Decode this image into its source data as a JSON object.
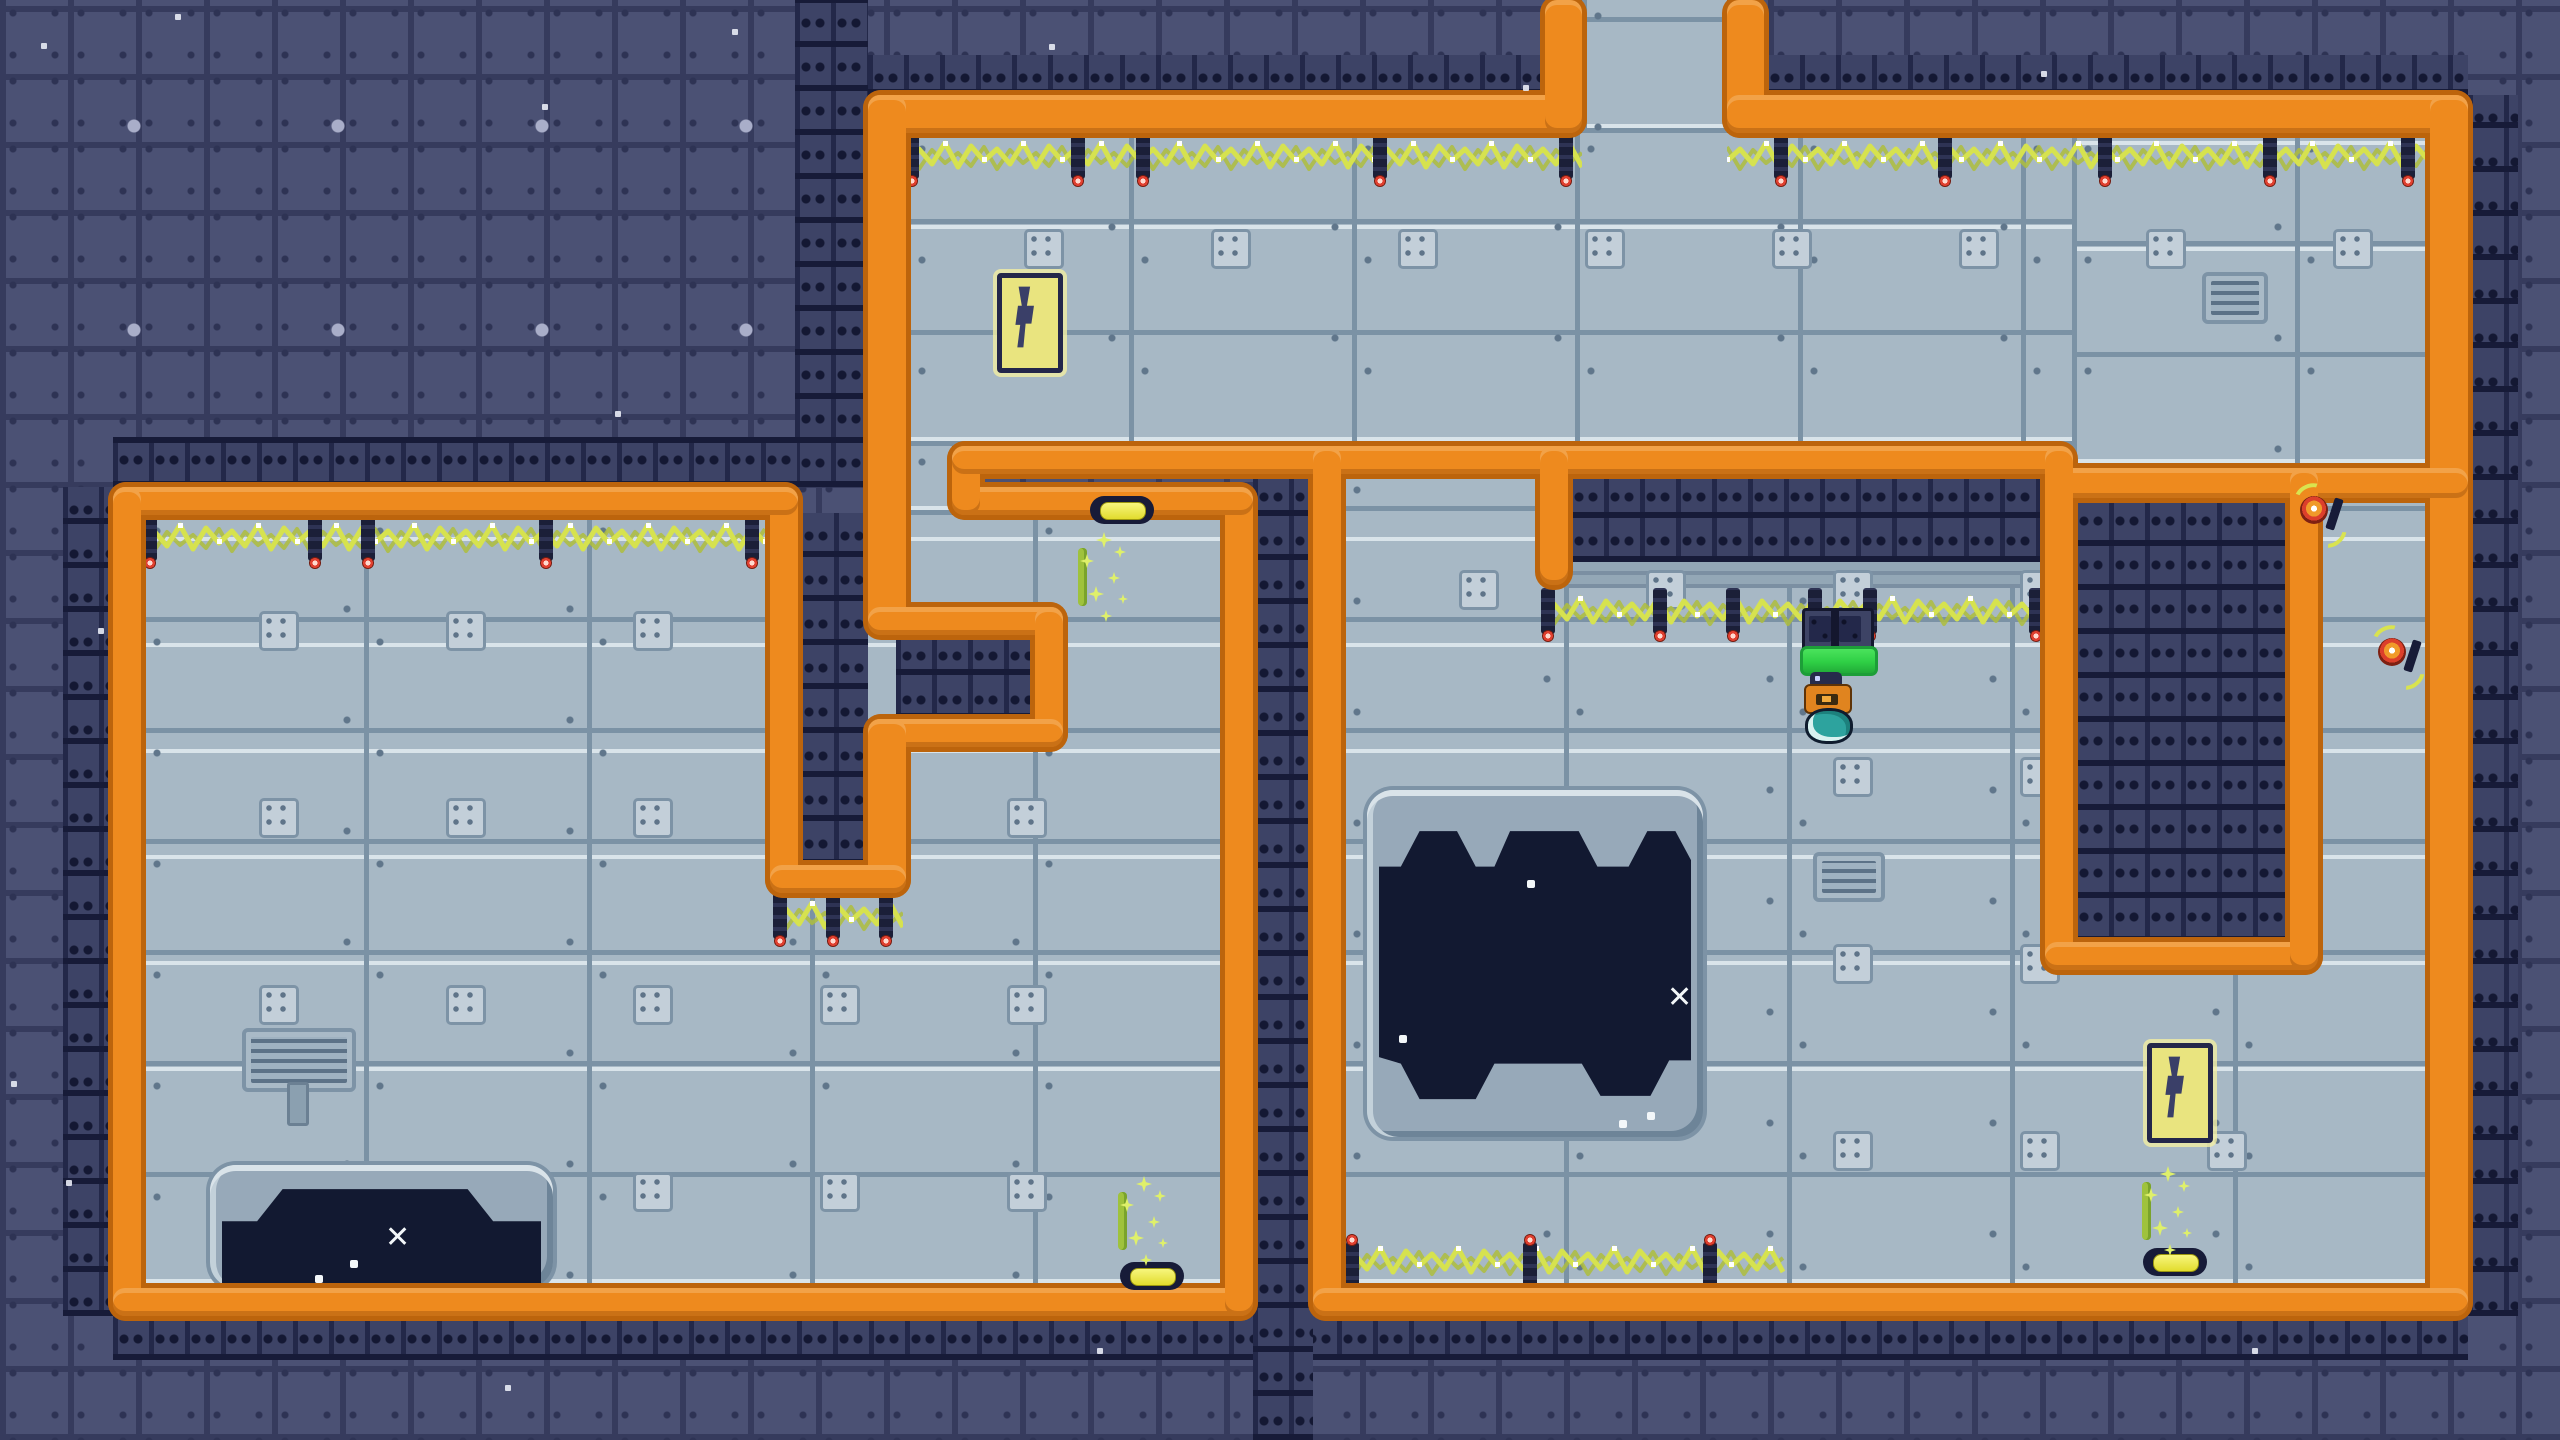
{
  "scene": {
    "type": "top-down pixel dungeon",
    "rooms": 3,
    "hazards": [
      "electric-wires",
      "pits"
    ],
    "player_present": true
  },
  "palette": {
    "background": "#4b5174",
    "background_grout": "#363b5d",
    "floor": "#a7b8c5",
    "floor_seam": "#7b92a5",
    "wall_orange": "#ee8a1e",
    "wall_outline": "#bc640c",
    "slot_brick": "#3d4366",
    "pit_dark": "#121931",
    "wire_yellow": "#d6e24f",
    "pin_red": "#e04030",
    "lamp_yellow": "#e9e344",
    "sign_yellow": "#e9e47f",
    "bolt_navy": "#3a3f68",
    "pad_green": "#35d948",
    "player_orange": "#e0841f",
    "bubble_teal": "#2da39e"
  },
  "map": {
    "floors": [
      {
        "x": 906,
        "y": 133,
        "w": 1524,
        "h": 313
      },
      {
        "x": 2072,
        "y": 133,
        "w": 358,
        "h": 335
      },
      {
        "x": 1582,
        "y": 0,
        "w": 145,
        "h": 133
      },
      {
        "x": 141,
        "y": 515,
        "w": 1084,
        "h": 773
      },
      {
        "x": 906,
        "y": 446,
        "w": 46,
        "h": 69
      },
      {
        "x": 1341,
        "y": 474,
        "w": 1089,
        "h": 814
      }
    ],
    "slots": [
      {
        "x": 868,
        "y": 55,
        "w": 677,
        "h": 40
      },
      {
        "x": 1764,
        "y": 55,
        "w": 704,
        "h": 40
      },
      {
        "x": 795,
        "y": 0,
        "w": 73,
        "h": 487
      },
      {
        "x": 113,
        "y": 437,
        "w": 685,
        "h": 50
      },
      {
        "x": 63,
        "y": 487,
        "w": 50,
        "h": 829
      },
      {
        "x": 113,
        "y": 1316,
        "w": 2355,
        "h": 44
      },
      {
        "x": 2468,
        "y": 95,
        "w": 50,
        "h": 1221
      },
      {
        "x": 798,
        "y": 513,
        "w": 70,
        "h": 352
      },
      {
        "x": 896,
        "y": 633,
        "w": 139,
        "h": 86
      },
      {
        "x": 1253,
        "y": 474,
        "w": 60,
        "h": 966
      },
      {
        "x": 1568,
        "y": 474,
        "w": 477,
        "h": 88
      },
      {
        "x": 2073,
        "y": 498,
        "w": 217,
        "h": 444
      }
    ],
    "ledges": [
      {
        "x": 1568,
        "y": 562,
        "w": 477,
        "h": 26
      }
    ],
    "walls": [
      {
        "x": 868,
        "y": 95,
        "w": 714,
        "h": 38
      },
      {
        "x": 1545,
        "y": 0,
        "w": 37,
        "h": 133
      },
      {
        "x": 1727,
        "y": 0,
        "w": 37,
        "h": 133
      },
      {
        "x": 1727,
        "y": 95,
        "w": 741,
        "h": 38
      },
      {
        "x": 2430,
        "y": 95,
        "w": 38,
        "h": 1221
      },
      {
        "x": 868,
        "y": 95,
        "w": 38,
        "h": 538
      },
      {
        "x": 868,
        "y": 607,
        "w": 195,
        "h": 28
      },
      {
        "x": 1035,
        "y": 607,
        "w": 28,
        "h": 140
      },
      {
        "x": 868,
        "y": 719,
        "w": 195,
        "h": 28
      },
      {
        "x": 868,
        "y": 719,
        "w": 38,
        "h": 174
      },
      {
        "x": 770,
        "y": 487,
        "w": 28,
        "h": 406
      },
      {
        "x": 770,
        "y": 865,
        "w": 136,
        "h": 28
      },
      {
        "x": 113,
        "y": 487,
        "w": 685,
        "h": 28
      },
      {
        "x": 113,
        "y": 487,
        "w": 28,
        "h": 829
      },
      {
        "x": 113,
        "y": 1288,
        "w": 1140,
        "h": 28
      },
      {
        "x": 1225,
        "y": 487,
        "w": 28,
        "h": 829
      },
      {
        "x": 952,
        "y": 487,
        "w": 301,
        "h": 28
      },
      {
        "x": 952,
        "y": 446,
        "w": 28,
        "h": 69
      },
      {
        "x": 952,
        "y": 446,
        "w": 1120,
        "h": 28
      },
      {
        "x": 2045,
        "y": 468,
        "w": 423,
        "h": 30
      },
      {
        "x": 1313,
        "y": 446,
        "w": 28,
        "h": 870
      },
      {
        "x": 1313,
        "y": 1288,
        "w": 1155,
        "h": 28
      },
      {
        "x": 1540,
        "y": 446,
        "w": 28,
        "h": 139
      },
      {
        "x": 2045,
        "y": 446,
        "w": 28,
        "h": 524
      },
      {
        "x": 2045,
        "y": 942,
        "w": 273,
        "h": 28
      },
      {
        "x": 2290,
        "y": 468,
        "w": 28,
        "h": 502
      }
    ],
    "wires": [
      {
        "x": 141,
        "y": 515,
        "w": 629,
        "dir": "down",
        "pins": [
          150,
          315,
          368,
          546,
          752
        ]
      },
      {
        "x": 773,
        "y": 893,
        "w": 130,
        "dir": "down",
        "pins": [
          780,
          833,
          886
        ]
      },
      {
        "x": 906,
        "y": 133,
        "w": 676,
        "dir": "down",
        "pins": [
          912,
          1078,
          1143,
          1380,
          1566
        ]
      },
      {
        "x": 1727,
        "y": 133,
        "w": 703,
        "dir": "down",
        "pins": [
          1781,
          1945,
          2105,
          2270,
          2408
        ]
      },
      {
        "x": 1541,
        "y": 588,
        "w": 504,
        "dir": "down",
        "pins": [
          1548,
          1660,
          1733,
          1815,
          1870,
          2036
        ]
      },
      {
        "x": 1341,
        "y": 1288,
        "w": 450,
        "dir": "up",
        "pins": [
          1352,
          1530,
          1710
        ]
      }
    ],
    "lamps": [
      {
        "x": 1090,
        "y": 496
      },
      {
        "x": 1120,
        "y": 1262
      },
      {
        "x": 2143,
        "y": 1248
      }
    ],
    "signs": [
      {
        "x": 997,
        "y": 273
      },
      {
        "x": 2147,
        "y": 1043
      }
    ],
    "vents": [
      {
        "x": 2202,
        "y": 272,
        "w": 58,
        "h": 44,
        "stem": false
      },
      {
        "x": 1813,
        "y": 852,
        "w": 64,
        "h": 42,
        "stem": false
      },
      {
        "x": 242,
        "y": 1028,
        "w": 106,
        "h": 56,
        "stem": true
      }
    ],
    "pits": [
      {
        "x": 1367,
        "y": 790,
        "w": 336,
        "h": 347,
        "kind": "big",
        "xmark": {
          "x": 300,
          "y": 193
        },
        "dots": [
          [
            160,
            90
          ],
          [
            32,
            245
          ],
          [
            252,
            330
          ],
          [
            280,
            322
          ]
        ]
      },
      {
        "x": 210,
        "y": 1165,
        "w": 343,
        "h": 123,
        "kind": "shallow",
        "xmark": {
          "x": 175,
          "y": 58
        },
        "dots": [
          [
            140,
            95
          ],
          [
            105,
            110
          ]
        ]
      }
    ],
    "sparkles": [
      {
        "x": 1078,
        "y": 528
      },
      {
        "x": 1118,
        "y": 1172
      },
      {
        "x": 2142,
        "y": 1162
      }
    ],
    "bursts": [
      {
        "x": 2300,
        "y": 496
      },
      {
        "x": 2378,
        "y": 638
      }
    ],
    "machine": {
      "x": 1802,
      "y": 608
    },
    "pad": {
      "x": 1800,
      "y": 646
    },
    "player": {
      "x": 1802,
      "y": 672
    }
  }
}
